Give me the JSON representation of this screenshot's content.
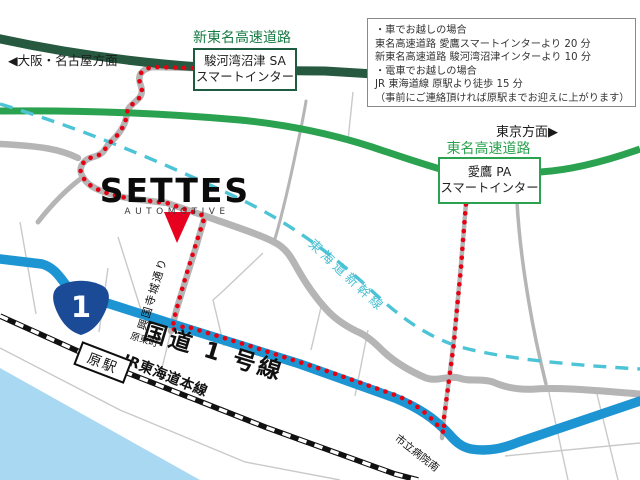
{
  "map": {
    "logo": {
      "name": "SETTES",
      "subtitle": "AUTOMOTIVE"
    },
    "directions": {
      "west": "◀大阪・名古屋方面",
      "east": "東京方面▶"
    },
    "expressways": {
      "shin_tomei": {
        "name": "新東名高速道路",
        "ic_line1": "駿河湾沼津 SA",
        "ic_line2": "スマートインター"
      },
      "tomei": {
        "name": "東名高速道路",
        "ic_line1": "愛鷹 PA",
        "ic_line2": "スマートインター"
      }
    },
    "roads": {
      "route1": {
        "name": "国道 1 号線",
        "shield_number": "1"
      },
      "kokokuji_dori": "興国寺城通り"
    },
    "railways": {
      "jr_line": "JR東海道本線",
      "shinkansen": "東海道新幹線",
      "station": "原駅"
    },
    "intersections": {
      "hara_higashicho": "原東町",
      "shiritsu_byoin_minami": "市立病院南"
    },
    "info_box": {
      "lines": [
        "・車でお越しの場合",
        "東名高速道路 愛鷹スマートインターより 20 分",
        "新東名高速道路 駿河湾沼津インターより 10 分",
        "・電車でお越しの場合",
        "JR 東海道線 原駅より徒歩 15 分",
        "（事前にご連絡頂ければ原駅までお迎えに上がります）"
      ]
    },
    "colors": {
      "shin_tomei_road": "#26593f",
      "shin_tomei_label": "#167a42",
      "tomei_road": "#2ba24f",
      "route1_blue": "#1e95d3",
      "shield_navy": "#1b4b97",
      "shinkansen_cyan": "#4cc4d6",
      "route_dot_red": "#e60012",
      "marker_red": "#e8001f",
      "sea": "#a9d8f3",
      "road_gray": "#b5b5b5"
    }
  }
}
